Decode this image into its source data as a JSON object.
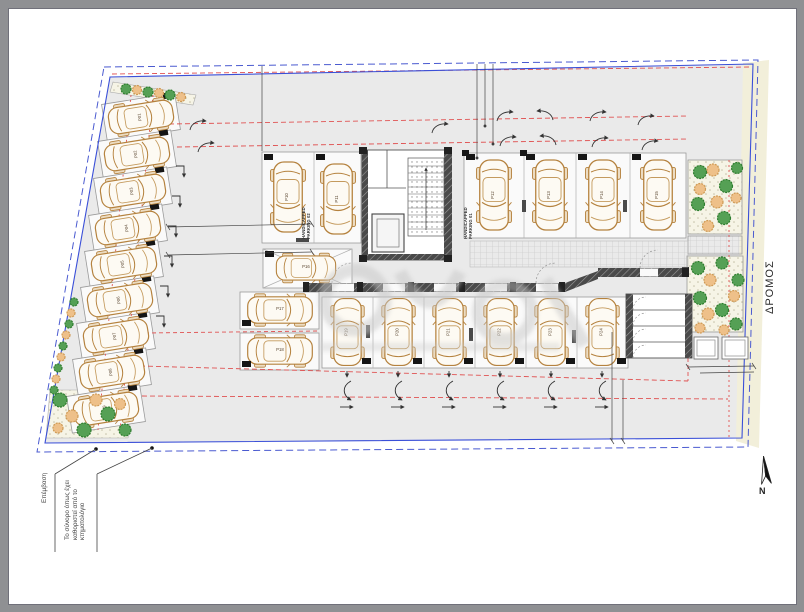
{
  "labels": {
    "road": "ΔΡΟΜΟΣ",
    "north": "N",
    "note_intervention": "Επέμβαση",
    "note_boundary": "Το σύνορο όπως έχει καθοριστεί από το κτηματολόγιο",
    "handicapped_parking_02": "HANDICAPPED PARKING 02",
    "handicapped_parking_01": "HANDICAPPED PARKING 01"
  },
  "parking": {
    "spaces": [
      {
        "label": "P01"
      },
      {
        "label": "P02"
      },
      {
        "label": "P03"
      },
      {
        "label": "P04"
      },
      {
        "label": "P05"
      },
      {
        "label": "P06"
      },
      {
        "label": "P07"
      },
      {
        "label": "P08"
      },
      {
        "label": "P09"
      },
      {
        "label": "P10"
      },
      {
        "label": "P11"
      },
      {
        "label": "P12"
      },
      {
        "label": "P13"
      },
      {
        "label": "P14"
      },
      {
        "label": "P15"
      },
      {
        "label": "P16"
      },
      {
        "label": "P17"
      },
      {
        "label": "P18"
      },
      {
        "label": "P19"
      },
      {
        "label": "P20"
      },
      {
        "label": "P21"
      },
      {
        "label": "P22"
      },
      {
        "label": "P23"
      },
      {
        "label": "P24"
      }
    ],
    "group_counts": {
      "left_row": 9,
      "top_middle": 2,
      "top_right": 4,
      "middle_row": 6,
      "side": 3
    }
  },
  "colors": {
    "boundary_blue": "#3a4fd8",
    "aisle_red": "#e05252",
    "car_outline": "#b5823e",
    "tree_green": "#4aa64a",
    "shrub_tan": "#eec089",
    "road_strip": "#f2efda",
    "plan_fill": "#eaeaea",
    "wall_dark": "#3c3c3c"
  }
}
